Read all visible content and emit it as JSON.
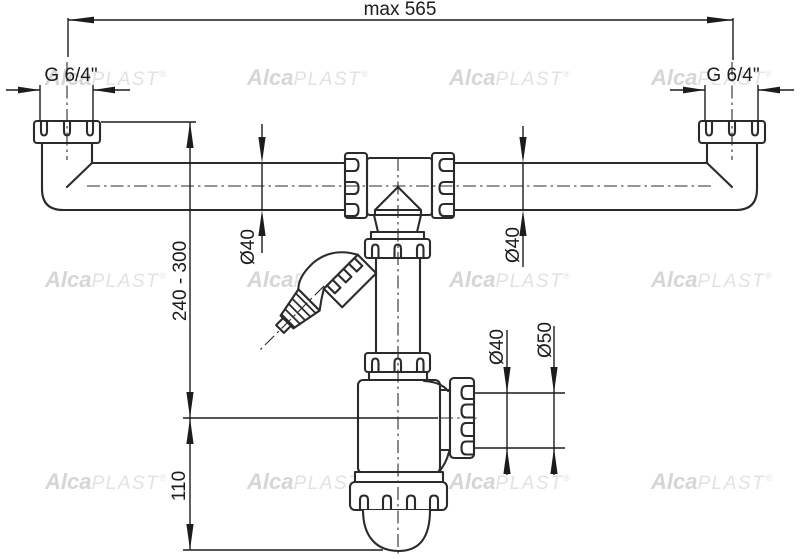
{
  "drawing": {
    "type": "technical-drawing",
    "subject": "double-bowl sink trap with washing machine connection",
    "dimensions": {
      "max_width": "max 565",
      "thread_size": "G 6/4\"",
      "height_range": "240 - 300",
      "trap_height": "110",
      "pipe_diameter": "Ø40",
      "outlet_diameter": "Ø50"
    },
    "watermark": {
      "alca": "Alca",
      "plast": "PLAST",
      "reg": "®"
    },
    "colors": {
      "line": "#2b2b2b",
      "dimension_line": "#1c1c1c",
      "background": "#ffffff",
      "watermark_bold": "#d6d6d6",
      "watermark_light": "#e2e2e2"
    }
  },
  "watermark": {
    "alca": "Alca",
    "plast": "PLAST",
    "reg": "®"
  },
  "dims": {
    "max_width": "max 565",
    "thread_size": "G 6/4\"",
    "height_range": "240 - 300",
    "trap_height": "110",
    "pipe_diameter": "Ø40",
    "outlet_diameter": "Ø50"
  }
}
